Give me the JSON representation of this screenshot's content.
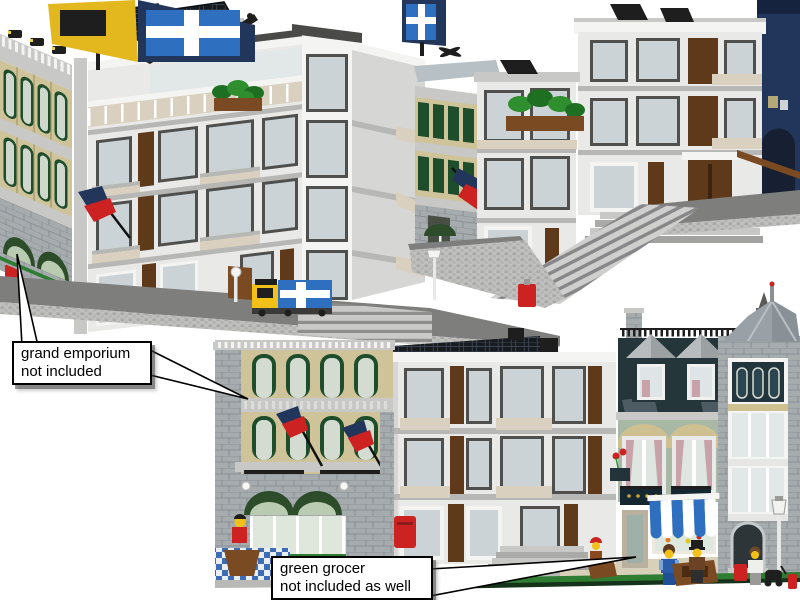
{
  "callouts": {
    "grand_emporium": {
      "line1": "grand emporium",
      "line2": "not included"
    },
    "green_grocer": {
      "line1": "green grocer",
      "line2": "not included as well"
    }
  },
  "colors": {
    "background": "#ffffff",
    "callout_fill": "#ffffff",
    "callout_border": "#000000",
    "callout_text": "#000000",
    "door_brown": "#5f3a1a",
    "emporium_tan": "#cfc39a",
    "emporium_window_green": "#1e4d2b",
    "awning_dark_green": "#2c4c2a",
    "grocer_facade_green": "#a8b8a5",
    "grocer_roof_slate": "#243639",
    "awning_blue": "#2f6fc0",
    "flag_navy": "#22365c",
    "brick_red": "#cc2222",
    "minifig_yellow": "#f2c119",
    "rail_tan": "#d9d0bf",
    "sidewalk_green": "#2e7d32"
  }
}
